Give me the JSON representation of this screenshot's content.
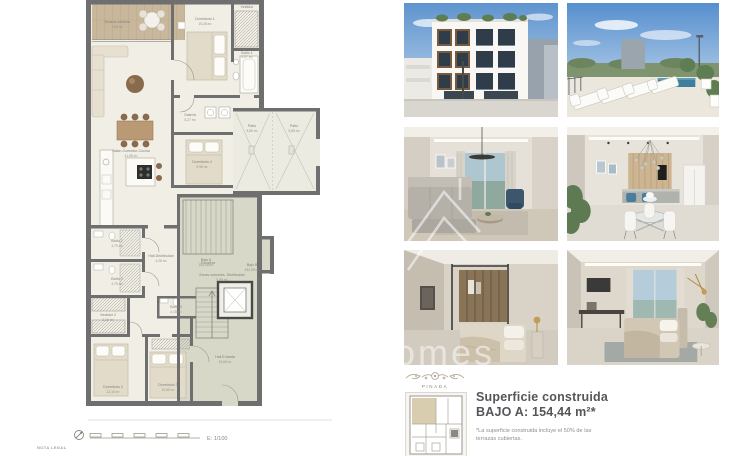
{
  "plan": {
    "scale_label": "E: 1/100",
    "nota_legal": "NOTA LEGAL",
    "rooms": {
      "terraza": {
        "name": "Terraza cubierta",
        "area": "7,60 m²"
      },
      "dormitorio1": {
        "name": "Dormitorio 1",
        "area": "15,28 m²"
      },
      "vestidor1": {
        "name": "Vestidor",
        "area": "3,21 m²"
      },
      "bano1": {
        "name": "Baño 1",
        "area": "4,57 m²"
      },
      "salon": {
        "name": "Salón-Comedor-Cocina",
        "area": "41,05 m²"
      },
      "galeria": {
        "name": "Galería",
        "area": "5,27 m²"
      },
      "dormitorio4": {
        "name": "Dormitorio 4",
        "area": "9,98 m²"
      },
      "patio1": {
        "name": "Patio",
        "area": "9,89 m²"
      },
      "patio2": {
        "name": "Patio",
        "area": "9,85 m²"
      },
      "escalera": {
        "name": "Escalera",
        "area": "10,92 m²"
      },
      "bano2": {
        "name": "Baño 2",
        "area": "4,79 m²"
      },
      "bano3": {
        "name": "Baño 3",
        "area": "4,79 m²"
      },
      "hall_distribuidor": {
        "name": "Hall-Distribuidor",
        "area": "4,25 m²"
      },
      "bajo_a": {
        "name": "Bajo A",
        "area": "154,44 m²"
      },
      "bajo_b": {
        "name": "Bajo B",
        "area": "152,69 m²"
      },
      "zonas_comunes": {
        "name": "Zonas comunes. Distribuidor",
        "area": "5,89 m²"
      },
      "bano4": {
        "name": "Baño 4",
        "area": "4,15 m²"
      },
      "vestidor2": {
        "name": "Vestidor 2",
        "area": "3,16 m²"
      },
      "dormitorio3": {
        "name": "Dormitorio 3",
        "area": "10,60 m²"
      },
      "dormitorio2": {
        "name": "Dormitorio 2",
        "area": "12,16 m²"
      },
      "hall_entrada": {
        "name": "Hall Entrada",
        "area": "19,60 m²"
      }
    }
  },
  "summary": {
    "brand": "PINADA",
    "title_line1": "Superficie construida",
    "title_line2": "BAJO A: 154,44 m²*",
    "footnote": "*La superficie construida incluye el 50% de las terrazas cubiertas."
  },
  "watermark": {
    "text": "homes",
    "house_icon": "house-outline-icon"
  },
  "gallery": {
    "photos": [
      {
        "name": "building-facade"
      },
      {
        "name": "rooftop-terrace-pool"
      },
      {
        "name": "living-room"
      },
      {
        "name": "dining-kitchen"
      },
      {
        "name": "bedroom-dressing"
      },
      {
        "name": "bedroom-window-view"
      }
    ]
  },
  "colors": {
    "wall": "#6f6f6f",
    "terrace_wood": "#c8b79b",
    "patio_floor": "#ecebe1",
    "common_zone": "#d8d8c8",
    "interior_floor": "#f1eee6",
    "sky": "#6d9ed6"
  }
}
